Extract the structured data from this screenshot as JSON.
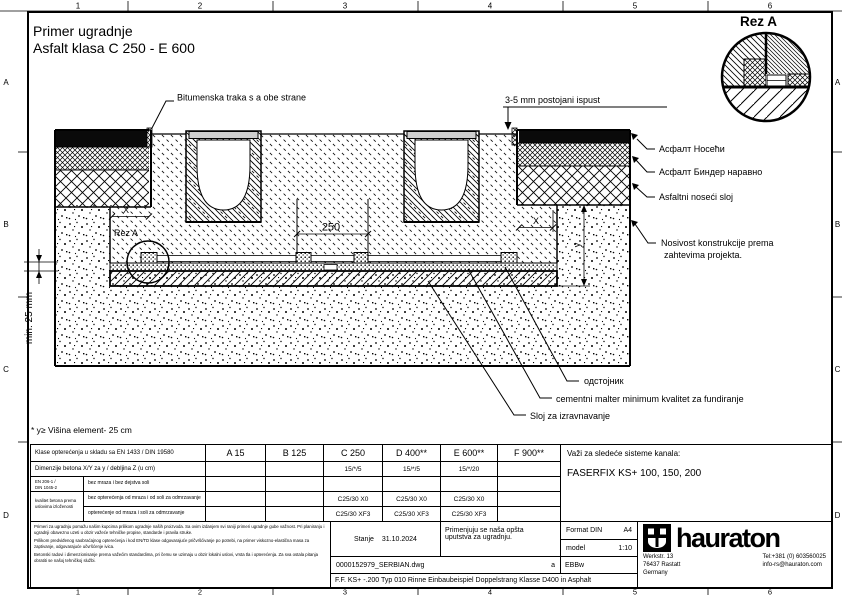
{
  "frame": {
    "cols": [
      "1",
      "2",
      "3",
      "4",
      "5",
      "6"
    ],
    "rows": [
      "A",
      "B",
      "C",
      "D"
    ]
  },
  "title": {
    "line1": "Primer ugradnje",
    "line2": "Asfalt klasa C 250 - E 600"
  },
  "detail": {
    "title": "Rez A"
  },
  "drawing": {
    "labels": {
      "bitumen": "Bitumenska traka s a obe strane",
      "ispust": "3-5 mm postojani ispust",
      "asfalt_noseci_cyr": "Асфалт Носећи",
      "asfalt_binder_cyr": "Асфалт Биндер наравно",
      "asfaltni_noseci": "Asfaltni noseći sloj",
      "nosivost1": "Nosivost konstrukcije prema",
      "nosivost2": "zahtevima projekta.",
      "odstojnik": "одстојник",
      "malter": "cementni malter minimum kvalitet za fundiranje",
      "sloj": "Sloj za izravnavanje",
      "rez_ref": "Rez A"
    },
    "dims": {
      "d250": "250",
      "x_left": "X",
      "x_right": "X",
      "y": "y",
      "min25": "min. 25 mm"
    },
    "note": "* y≥ Višina element- 25 cm"
  },
  "table": {
    "row1_label": "Klase opterećenja u skladu sa EN 1433 / DIN 19580",
    "row2_label": "Dimenzije betona X/Y za y / debljina Z (u cm)",
    "row3_left1": "EN 206-1 /",
    "row3_left2": "DIN 1045-2",
    "row45_left1": "kvalitet betona prema",
    "row45_left2": "uslovima izloženosti",
    "row3_label": "bez mraza i bez dejstva soli",
    "row4_label": "bez opterećenja od mraza i od soli za odmrzavanje",
    "row5_label": "opterećenje od mraza i soli za odmrzavanje",
    "classes": [
      "A 15",
      "B 125",
      "C 250",
      "D 400**",
      "E 600**",
      "F 900**"
    ],
    "row2": [
      "",
      "",
      "15/*/5",
      "15/*/5",
      "15/*/20",
      ""
    ],
    "row4": [
      "",
      "",
      "C25/30 X0",
      "C25/30 X0",
      "C25/30 X0",
      ""
    ],
    "row5": [
      "",
      "",
      "C25/30 XF3",
      "C25/30 XF3",
      "C25/30 XF3",
      ""
    ]
  },
  "systems": {
    "heading": "Važi za sledeće sisteme kanala:",
    "value": "FASERFIX KS+ 100, 150, 200"
  },
  "fineprint": {
    "p1": "Primeri za ugradnju pomažu našim kupcima prilikom ugradnje naših proizvoda. Sa ovim izdanjem svi raniji primeri ugradnje gube važnost. Pri planiranju i ugradnji obavezno uzeti u obzir važeće tehničke propise, standarde i pravila struke.",
    "p2": "Prilikom predviđenog saobraćajnog opterećenja i kod EN/TD klase odgovarajuće pričvršćivanje po potrebi, na primer viskozno-elastična masa za zaptivanje, odgovarajuće učvršćenje ivica.",
    "p3": "Betonski radovi i dimenzionisanje prema važećim standardima, pri čemu se uzimaju u obzir lokalni uslovi, vrsta tla i opterećenja. Za sva ostala pitanja obratiti se našoj tehničkoj službi."
  },
  "titleblock": {
    "stanje_label": "Stanje",
    "date": "31.10.2024",
    "note1": "Primenjuju se naša opšta",
    "note2": "uputstva za ugradnju.",
    "format_label": "Format DIN",
    "format_value": "A4",
    "scale_label": "model",
    "scale_value": "1:10",
    "code": "EBBw",
    "file": "0000152979_SERBIAN.dwg",
    "rev": "a",
    "description": "F.F. KS+ -.200 Typ 010 Rinne Einbaubeispiel Doppelstrang Klasse D400 in Asphalt",
    "brand": "hauraton",
    "addr1": "Werkstr. 13",
    "addr2": "76437 Rastatt",
    "addr3": "Germany",
    "tel": "Tel:+381 (0) 603560025",
    "email": "info-rs@hauraton.com"
  }
}
